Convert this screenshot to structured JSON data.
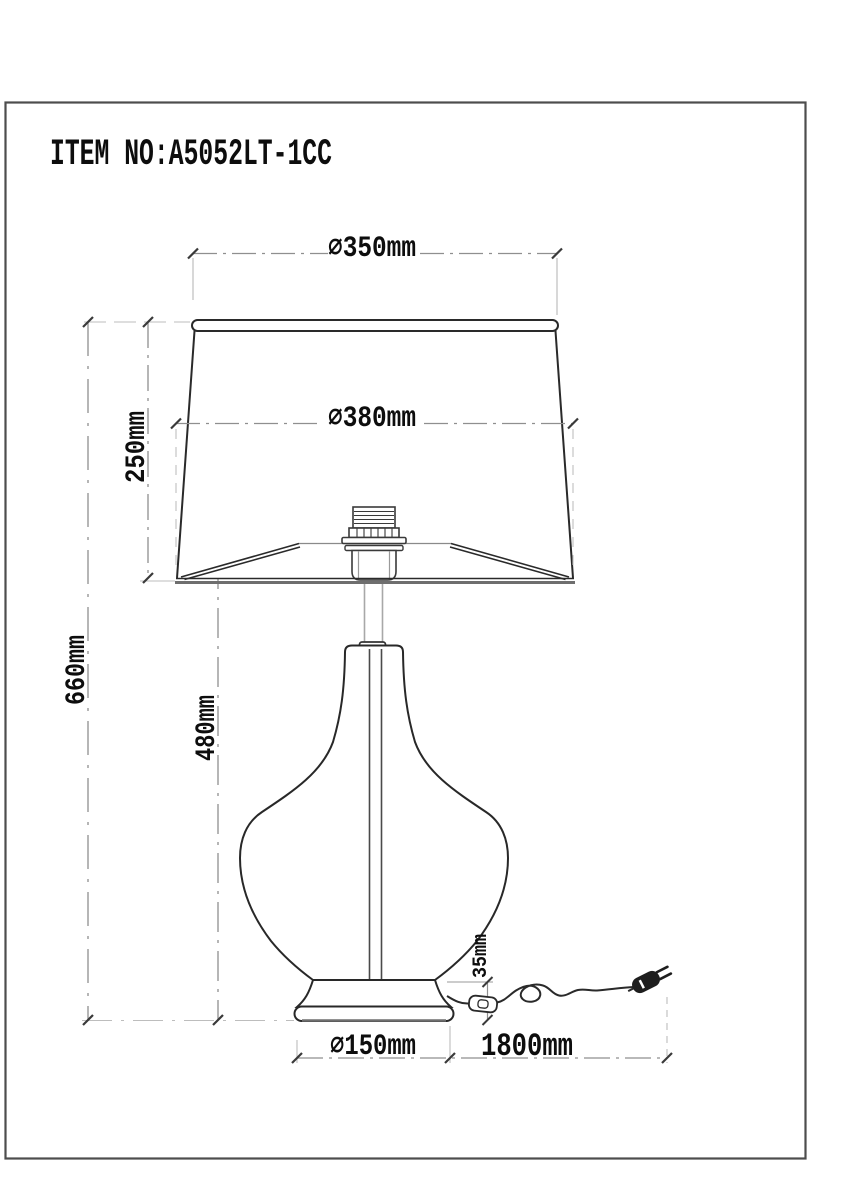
{
  "title": "ITEM NO:A5052LT-1CC",
  "dimensions": {
    "shade_top_diameter": "∅350mm",
    "shade_bottom_diameter": "∅380mm",
    "shade_height": "250mm",
    "total_height": "660mm",
    "body_height": "480mm",
    "cord_exit_height": "35mm",
    "base_diameter": "∅150mm",
    "cord_length": "1800mm"
  },
  "colors": {
    "object_line": "#2a2a2a",
    "dimension_line": "#8f8f8f",
    "extension_line": "#bdbdbd",
    "tick": "#3a3a3a",
    "text": "#0d0d0d",
    "border": "#4d4d4d",
    "background": "#ffffff"
  }
}
